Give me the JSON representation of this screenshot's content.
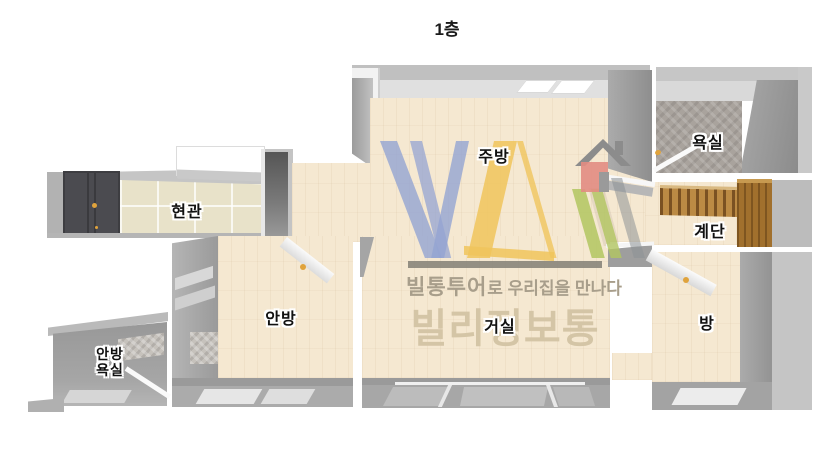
{
  "title": "1층",
  "rooms": {
    "kitchen": "주방",
    "bathroom": "욕실",
    "entrance": "현관",
    "stairs": "계단",
    "master_bedroom": "안방",
    "living_room": "거실",
    "small_room": "방",
    "master_bathroom_line1": "안방",
    "master_bathroom_line2": "욕실"
  },
  "watermark": {
    "tagline_brand": "빌통투어",
    "tagline_rest": "로 우리집을 만나다",
    "brand_name": "빌리정보통"
  },
  "colors": {
    "floor_wood": "#f5e8d1",
    "entrance_tile": "#e8e2c9",
    "wall_grey": "#b0b0b0",
    "wall_dark": "#8e8e8e",
    "front_door": "#4b4b50",
    "stair_wood": "#bb8a44",
    "logo_blue": "#94a4d2",
    "logo_yellow": "#f0c45c",
    "logo_green": "#b2c660",
    "house_red": "#e28c82",
    "handle_yellow": "#e0a33c",
    "brand_text": "#d4c5a6"
  }
}
